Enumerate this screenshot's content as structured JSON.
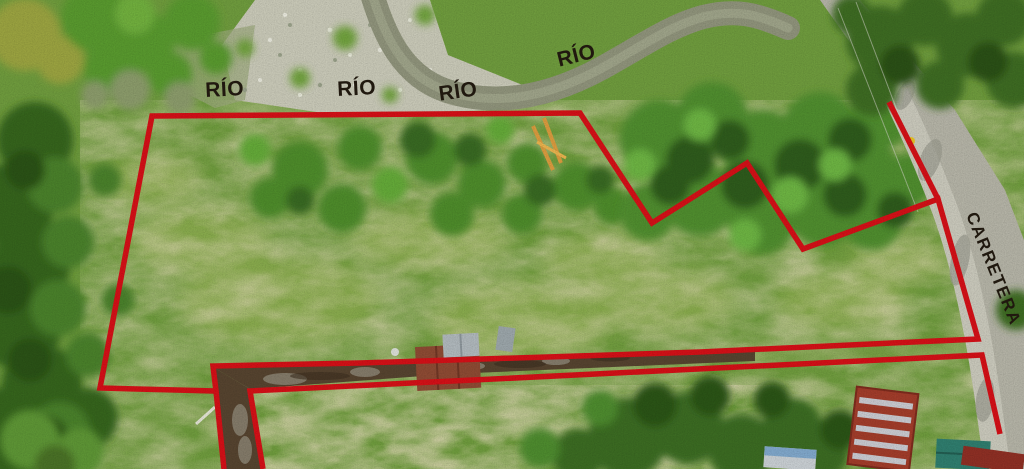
{
  "image": {
    "width": 1024,
    "height": 469,
    "kind": "aerial-drone-photo-of-land-parcel"
  },
  "annotations": {
    "boundary_color": "#d21017",
    "boundary_width": 5.5,
    "label_color": "#221a10",
    "labels": [
      {
        "id": "rio-1",
        "text": "RÍO",
        "x": 225,
        "y": 96,
        "rotation": -3,
        "font_size": 21,
        "anchor": "middle",
        "letter_spacing": 0.5
      },
      {
        "id": "rio-2",
        "text": "RÍO",
        "x": 357,
        "y": 95,
        "rotation": -3,
        "font_size": 21,
        "anchor": "middle",
        "letter_spacing": 0.5
      },
      {
        "id": "rio-3",
        "text": "RÍO",
        "x": 459,
        "y": 98,
        "rotation": -8,
        "font_size": 21,
        "anchor": "middle",
        "letter_spacing": 0.5
      },
      {
        "id": "rio-4",
        "text": "RÍO",
        "x": 578,
        "y": 62,
        "rotation": -14,
        "font_size": 21,
        "anchor": "middle",
        "letter_spacing": 0.5
      },
      {
        "id": "carretera",
        "text": "CARRETERA",
        "x": 966,
        "y": 215,
        "rotation": 68,
        "font_size": 17,
        "anchor": "start",
        "letter_spacing": 1.5
      }
    ],
    "boundaries": [
      {
        "id": "main-parcel",
        "closed": true,
        "points": [
          [
            152,
            116
          ],
          [
            580,
            113
          ],
          [
            652,
            223
          ],
          [
            747,
            163
          ],
          [
            803,
            249
          ],
          [
            938,
            199
          ],
          [
            978,
            339
          ],
          [
            700,
            352
          ],
          [
            360,
            363
          ],
          [
            213,
            366
          ],
          [
            216,
            391
          ],
          [
            100,
            388
          ]
        ]
      },
      {
        "id": "northeast-road-spur",
        "closed": false,
        "points": [
          [
            889,
            102
          ],
          [
            938,
            199
          ]
        ]
      },
      {
        "id": "south-left-extension",
        "closed": false,
        "points": [
          [
            216,
            391
          ],
          [
            224,
            469
          ]
        ]
      },
      {
        "id": "lower-track-line",
        "closed": false,
        "points": [
          [
            263,
            469
          ],
          [
            250,
            391
          ],
          [
            982,
            355
          ],
          [
            1000,
            434
          ]
        ]
      }
    ]
  }
}
